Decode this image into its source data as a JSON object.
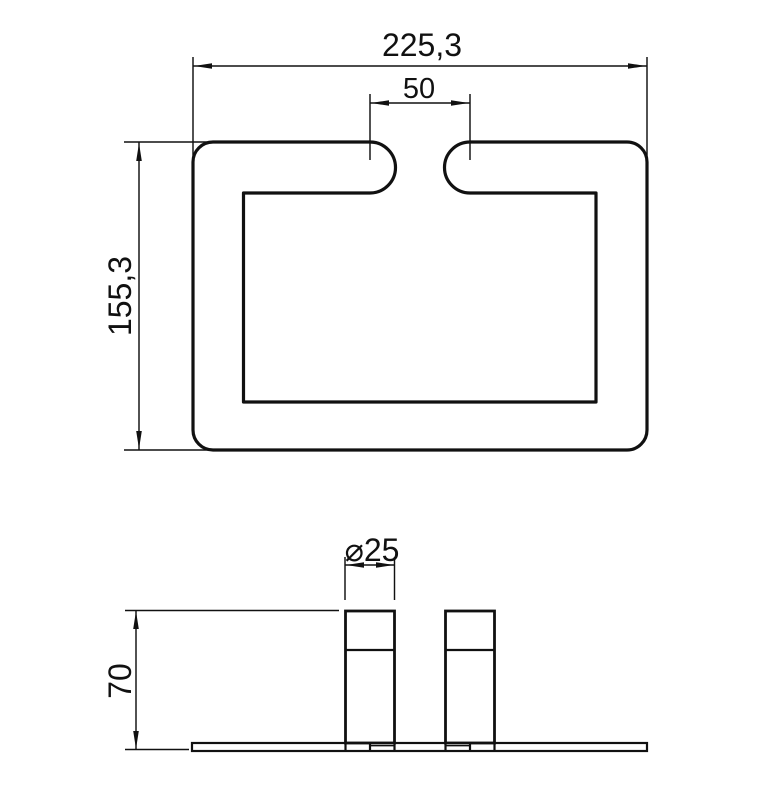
{
  "drawing": {
    "background": "#ffffff",
    "line_color": "#111111",
    "top_view": {
      "width_dim": "225,3",
      "slot_dim": "50",
      "height_dim": "155,3"
    },
    "front_view": {
      "diameter_dim": "⌀25",
      "height_dim": "70"
    }
  }
}
